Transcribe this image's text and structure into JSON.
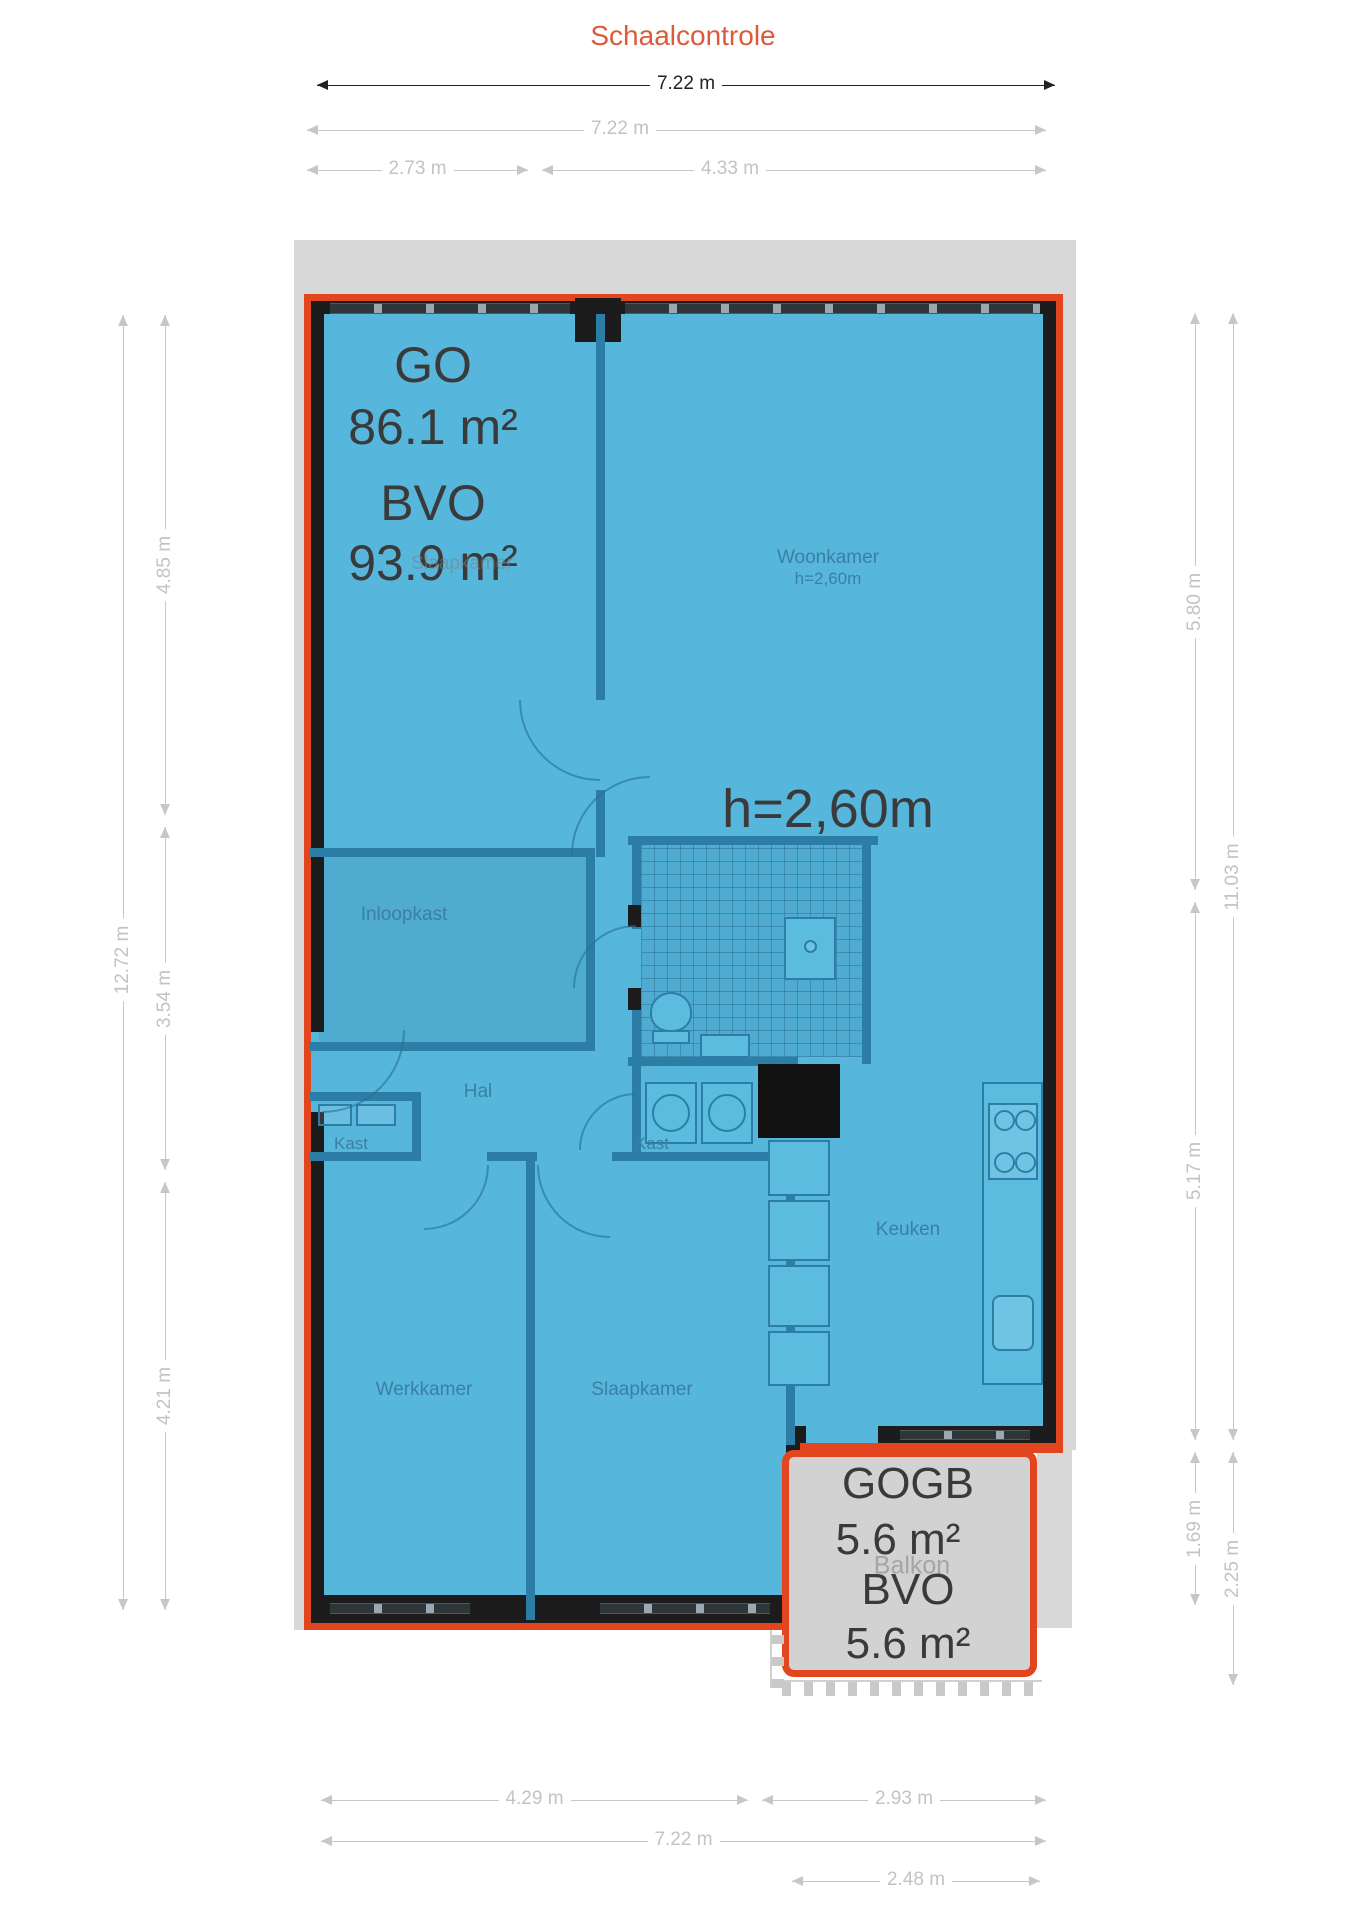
{
  "title": "Schaalcontrole",
  "plan": {
    "area_summary": {
      "go_label": "GO",
      "go_value": "86.1 m²",
      "bvo_label": "BVO",
      "bvo_value": "93.9 m²"
    },
    "ceiling_height_note": "h=2,60m",
    "rooms": [
      {
        "id": "woonkamer",
        "label": "Woonkamer",
        "sub": "h=2,60m",
        "x": 828,
        "y": 568
      },
      {
        "id": "slaapkamer-ghost",
        "label": "Slaapkamer",
        "x": 462,
        "y": 564,
        "faint": true
      },
      {
        "id": "inloopkast",
        "label": "Inloopkast",
        "x": 404,
        "y": 915
      },
      {
        "id": "hal",
        "label": "Hal",
        "x": 478,
        "y": 1092
      },
      {
        "id": "kast-left",
        "label": "Kast",
        "x": 351,
        "y": 1144,
        "size": 17
      },
      {
        "id": "kast-center",
        "label": "Kast",
        "x": 652,
        "y": 1144,
        "size": 17
      },
      {
        "id": "keuken",
        "label": "Keuken",
        "x": 908,
        "y": 1230
      },
      {
        "id": "werkkamer",
        "label": "Werkkamer",
        "x": 424,
        "y": 1390
      },
      {
        "id": "slaapkamer",
        "label": "Slaapkamer",
        "x": 642,
        "y": 1390
      },
      {
        "id": "balkon-ghost",
        "label": "Balkon",
        "x": 912,
        "y": 1566,
        "faint": true,
        "size": 25
      }
    ],
    "balcony_summary": {
      "gogb_label": "GOGB",
      "gogb_value": "5.6 m²",
      "bvo_label": "BVO",
      "bvo_value": "5.6 m²"
    }
  },
  "dimensions": [
    {
      "id": "top-overall-dark",
      "orient": "h",
      "at": 85,
      "from": 317,
      "to": 1055,
      "label": "7.22 m",
      "dark": true
    },
    {
      "id": "top-overall",
      "orient": "h",
      "at": 130,
      "from": 307,
      "to": 1046,
      "label": "7.22 m",
      "label_at": 620
    },
    {
      "id": "top-left-part",
      "orient": "h",
      "at": 170,
      "from": 307,
      "to": 528,
      "label": "2.73 m"
    },
    {
      "id": "top-right-part",
      "orient": "h",
      "at": 170,
      "from": 542,
      "to": 1046,
      "label": "4.33 m",
      "label_at": 730
    },
    {
      "id": "left-overall",
      "orient": "v",
      "at": 123,
      "from": 315,
      "to": 1610,
      "label": "12.72 m",
      "label_at": 960
    },
    {
      "id": "left-seg-1",
      "orient": "v",
      "at": 165,
      "from": 315,
      "to": 815,
      "label": "4.85 m"
    },
    {
      "id": "left-seg-2",
      "orient": "v",
      "at": 165,
      "from": 827,
      "to": 1170,
      "label": "3.54 m"
    },
    {
      "id": "left-seg-3",
      "orient": "v",
      "at": 165,
      "from": 1182,
      "to": 1610,
      "label": "4.21 m"
    },
    {
      "id": "right-seg-1",
      "orient": "v",
      "at": 1195,
      "from": 313,
      "to": 890,
      "label": "5.80 m"
    },
    {
      "id": "right-seg-2",
      "orient": "v",
      "at": 1195,
      "from": 902,
      "to": 1440,
      "label": "5.17 m"
    },
    {
      "id": "right-seg-3",
      "orient": "v",
      "at": 1195,
      "from": 1452,
      "to": 1605,
      "label": "1.69 m"
    },
    {
      "id": "right-overall",
      "orient": "v",
      "at": 1233,
      "from": 313,
      "to": 1440,
      "label": "11.03 m"
    },
    {
      "id": "right-balcony",
      "orient": "v",
      "at": 1233,
      "from": 1452,
      "to": 1685,
      "label": "2.25 m"
    },
    {
      "id": "bottom-left-part",
      "orient": "h",
      "at": 1800,
      "from": 321,
      "to": 748,
      "label": "4.29 m"
    },
    {
      "id": "bottom-right-part",
      "orient": "h",
      "at": 1800,
      "from": 762,
      "to": 1046,
      "label": "2.93 m"
    },
    {
      "id": "bottom-overall",
      "orient": "h",
      "at": 1841,
      "from": 321,
      "to": 1046,
      "label": "7.22 m"
    },
    {
      "id": "bottom-balcony",
      "orient": "h",
      "at": 1881,
      "from": 792,
      "to": 1040,
      "label": "2.48 m"
    }
  ],
  "colors": {
    "outline_red": "#E3461F",
    "room_blue": "#56B6DC",
    "wall_black": "#1C1C1C",
    "interior_wall_blue": "#2D7EA6",
    "dim_gray": "#C7C7C7",
    "dim_dark": "#222222",
    "title_red": "#DB5B3B",
    "balcony_gray": "#D2D2D2",
    "underlay_gray": "#D8D8D8",
    "big_text": "#3A3A3A",
    "room_label": "#3B7FA4"
  }
}
